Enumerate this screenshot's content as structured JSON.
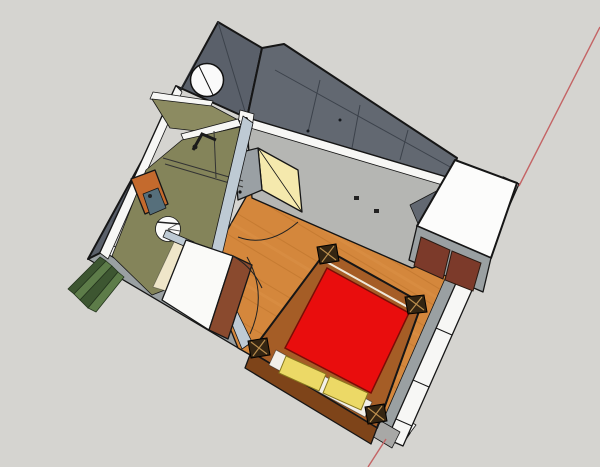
{
  "scene": {
    "description": "aerial-3d-view-bedroom-with-ensuite-bathroom",
    "view": "top-down-perspective",
    "visible_text": "",
    "objects": [
      "exterior-dark-walls",
      "white-wall-tops",
      "bathroom",
      "round-fixture",
      "shower-glass",
      "shower-head",
      "vanity",
      "sink",
      "toilet",
      "bath-mat",
      "entry-doorway",
      "open-door-leaf",
      "door-swing-arcs",
      "partition-walls",
      "bedroom-wood-floor",
      "four-poster-bed",
      "red-bedspread",
      "yellow-pillows",
      "bed-posts",
      "headboard",
      "wardrobe",
      "dresser",
      "plant-leaves",
      "red-axis-line"
    ]
  },
  "colors": {
    "background": "#d5d4d0",
    "edge": "#161616",
    "wallDark": "#5a606a",
    "wallDark2": "#626871",
    "wallDarkSeam": "#3c424b",
    "wallTop": "#f7f7f5",
    "wallMid": "#9aa0a2",
    "wallCap": "#a8a8a6",
    "interiorWall": "#b5b6b3",
    "partition": "#becad4",
    "bathroomWall": "#8c8b61",
    "bathroomFloor": "#84845a",
    "creamMat": "#efe6c9",
    "doorGlow": "#f5e9ad",
    "doorLeaf": "#9aa0a4",
    "bedroomFloor": "#d4873c",
    "floorStreak": "#b86f28",
    "floorStreakLight": "#e09a50",
    "bedSpread": "#e90d0d",
    "bedSpreadEdge": "#7a0d06",
    "bedFrame": "#a55d26",
    "bedFrameDark": "#7e4419",
    "postCap": "#342512",
    "postStar": "#b98d4d",
    "pillowYellow": "#ecd966",
    "pillowEdge": "#8a7a1e",
    "pillowWhite": "#f3f0e9",
    "wardrobeTop": "#fcfcfb",
    "wardrobeDoor": "#7c3a2a",
    "cabinetTop": "#fafaf8",
    "cabinetFront": "#8a4a2e",
    "vanityWood": "#c46a2d",
    "sinkBasin": "#566f7b",
    "toiletWhite": "#fbfbfa",
    "plantGreen": "#5d7c49",
    "plantGreenDark": "#3d5631",
    "axisRed": "#c46465",
    "fixtureWhite": "#fafafa"
  }
}
